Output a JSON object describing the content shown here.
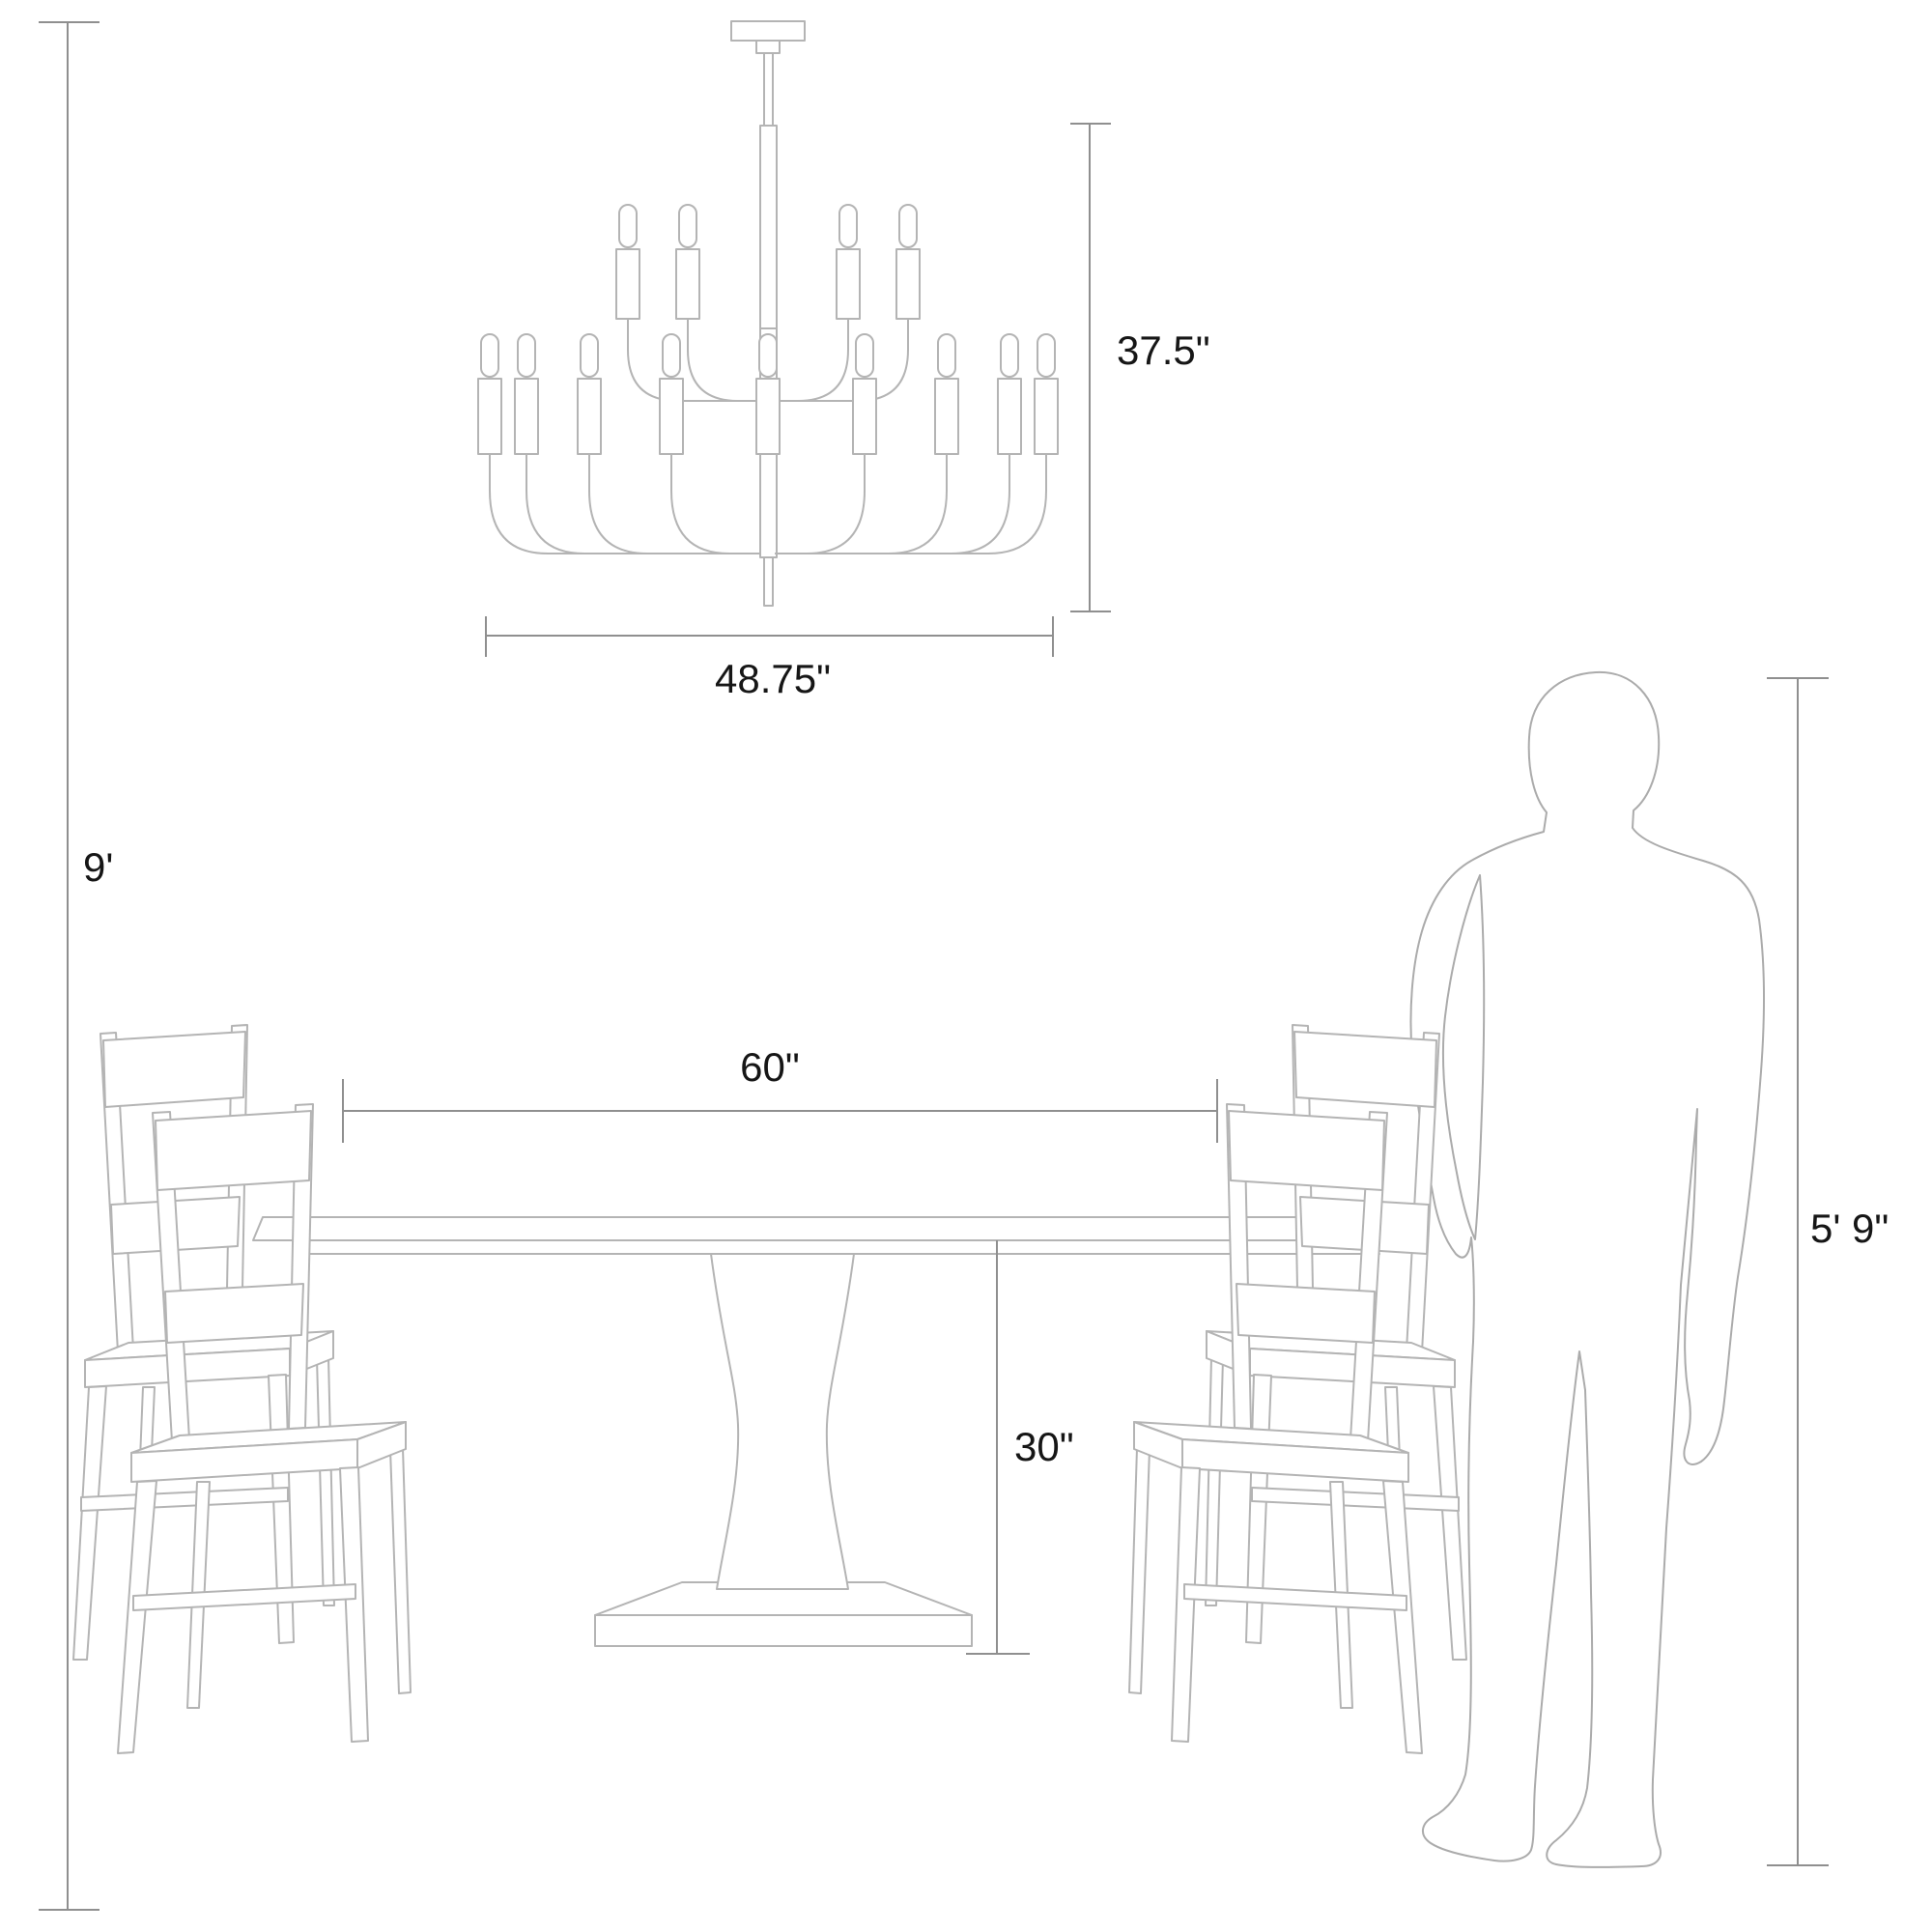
{
  "diagram": {
    "title": "Dining set with chandelier size diagram",
    "colors": {
      "background": "#ffffff",
      "furniture_line": "#b4b4b4",
      "person_line": "#ababab",
      "dimension_line": "#8f8f8f",
      "label_text": "#161616"
    },
    "dimensions": {
      "ceiling_height": {
        "label": "9'"
      },
      "chandelier_height": {
        "label": "37.5\""
      },
      "chandelier_width": {
        "label": "48.75\""
      },
      "table_width": {
        "label": "60\""
      },
      "table_height": {
        "label": "30\""
      },
      "person_height": {
        "label": "5' 9\""
      }
    },
    "objects": [
      "chandelier",
      "pedestal dining table",
      "dining chairs",
      "person silhouette"
    ]
  }
}
